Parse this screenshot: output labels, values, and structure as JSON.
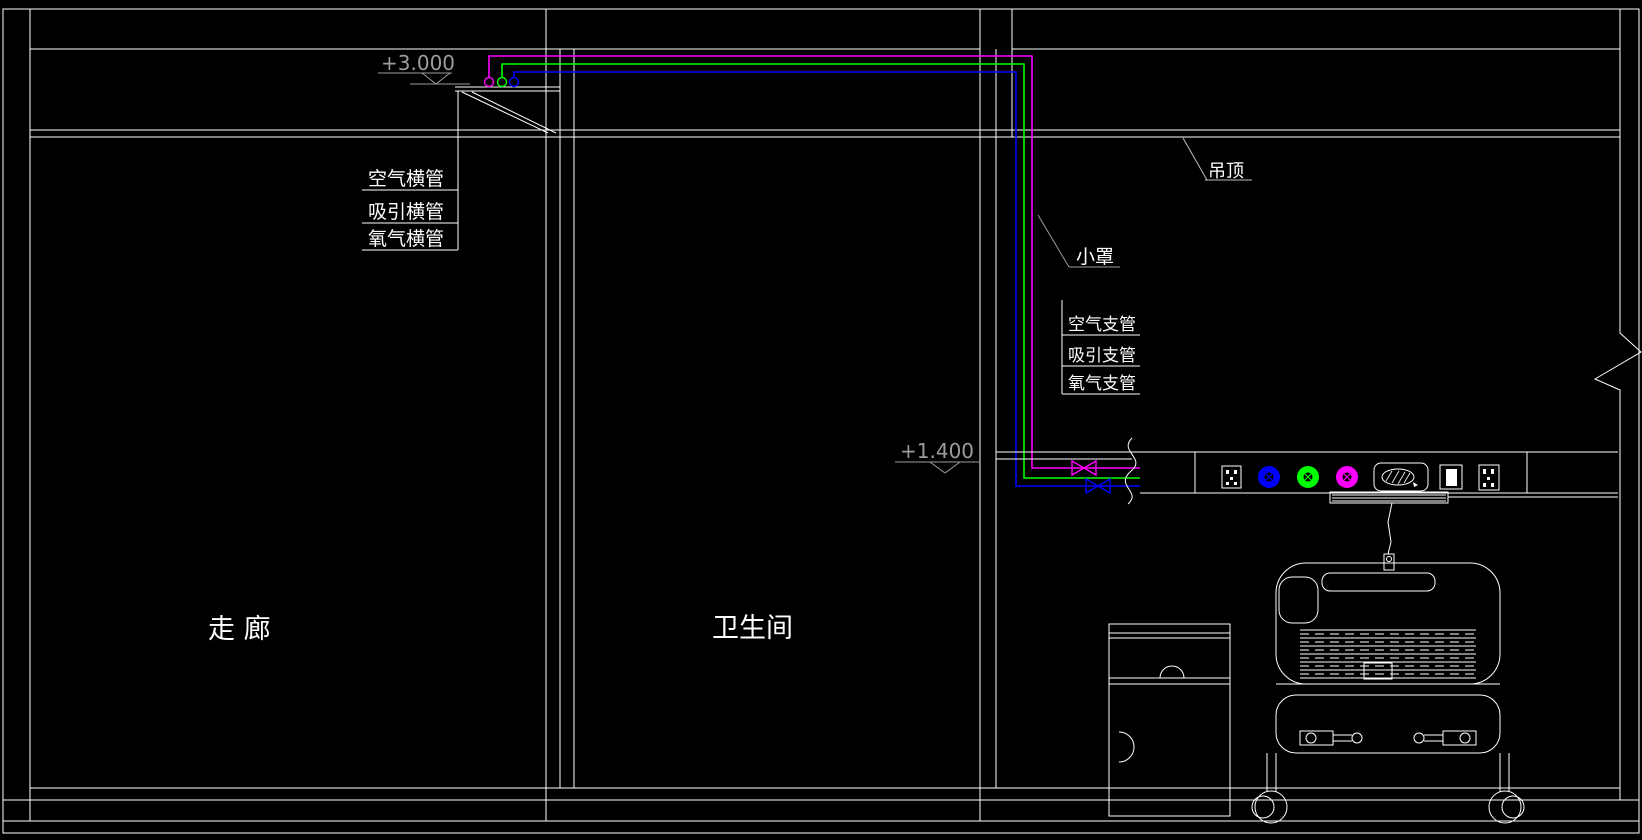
{
  "drawing_type": "CAD medical-gas piping elevation",
  "colors": {
    "background": "#000000",
    "structure_lines": "#FFFFFF",
    "dimension_gray": "#9C9C9C",
    "pipe_oxygen_magenta": "#FF00FF",
    "pipe_suction_green": "#00FF00",
    "pipe_air_blue": "#0000FF"
  },
  "rooms": {
    "corridor": "走 廊",
    "bathroom": "卫生间"
  },
  "elevations": {
    "upper": "+3.000",
    "lower": "+1.400"
  },
  "labels": {
    "h_pipes": [
      "空气横管",
      "吸引横管",
      "氧气横管"
    ],
    "branch_pipes": [
      "空气支管",
      "吸引支管",
      "氧气支管"
    ],
    "ceiling": "吊顶",
    "hood": "小罩"
  },
  "bed_head_unit": {
    "icons": [
      "power-socket",
      "gas-outlet-blue",
      "gas-outlet-green",
      "gas-outlet-magenta",
      "nurse-call-speaker",
      "switch",
      "power-socket"
    ],
    "valves": [
      "magenta-valve",
      "blue-valve"
    ]
  },
  "furniture": [
    "bedside-cabinet",
    "hospital-bed",
    "nurse-call-pendant"
  ]
}
